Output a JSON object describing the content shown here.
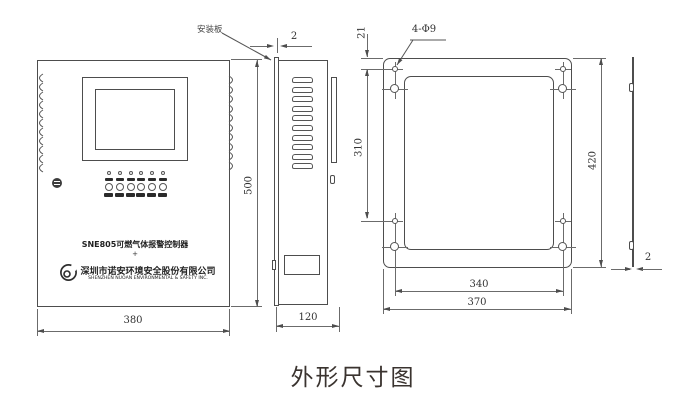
{
  "caption": "外形尺寸图",
  "labels": {
    "mounting_plate": "安装板",
    "mounting_holes": "4-Φ9"
  },
  "front_panel": {
    "model_title": "SNE805可燃气体报警控制器",
    "separator_mark": "+",
    "company_cn": "深圳市诺安环境安全股份有限公司",
    "company_en": "SHENZHEN NUOAN ENVIRONMENTAL & SAFETY INC.",
    "led_count": 6,
    "button_count": 6
  },
  "dimensions": {
    "front_width": "380",
    "front_height": "500",
    "side_depth": "120",
    "plate_thickness_top": "2",
    "hole_offset_top": "21",
    "hole_spacing_vertical": "310",
    "rear_plate_height": "420",
    "hole_spacing_horizontal": "340",
    "rear_plate_width": "370",
    "plate_thickness_profile": "2"
  },
  "colors": {
    "drawing_line": "#4d4d4d",
    "dimension_line": "#6b6b6b",
    "text": "#333333",
    "caption_text": "#3a332f"
  }
}
